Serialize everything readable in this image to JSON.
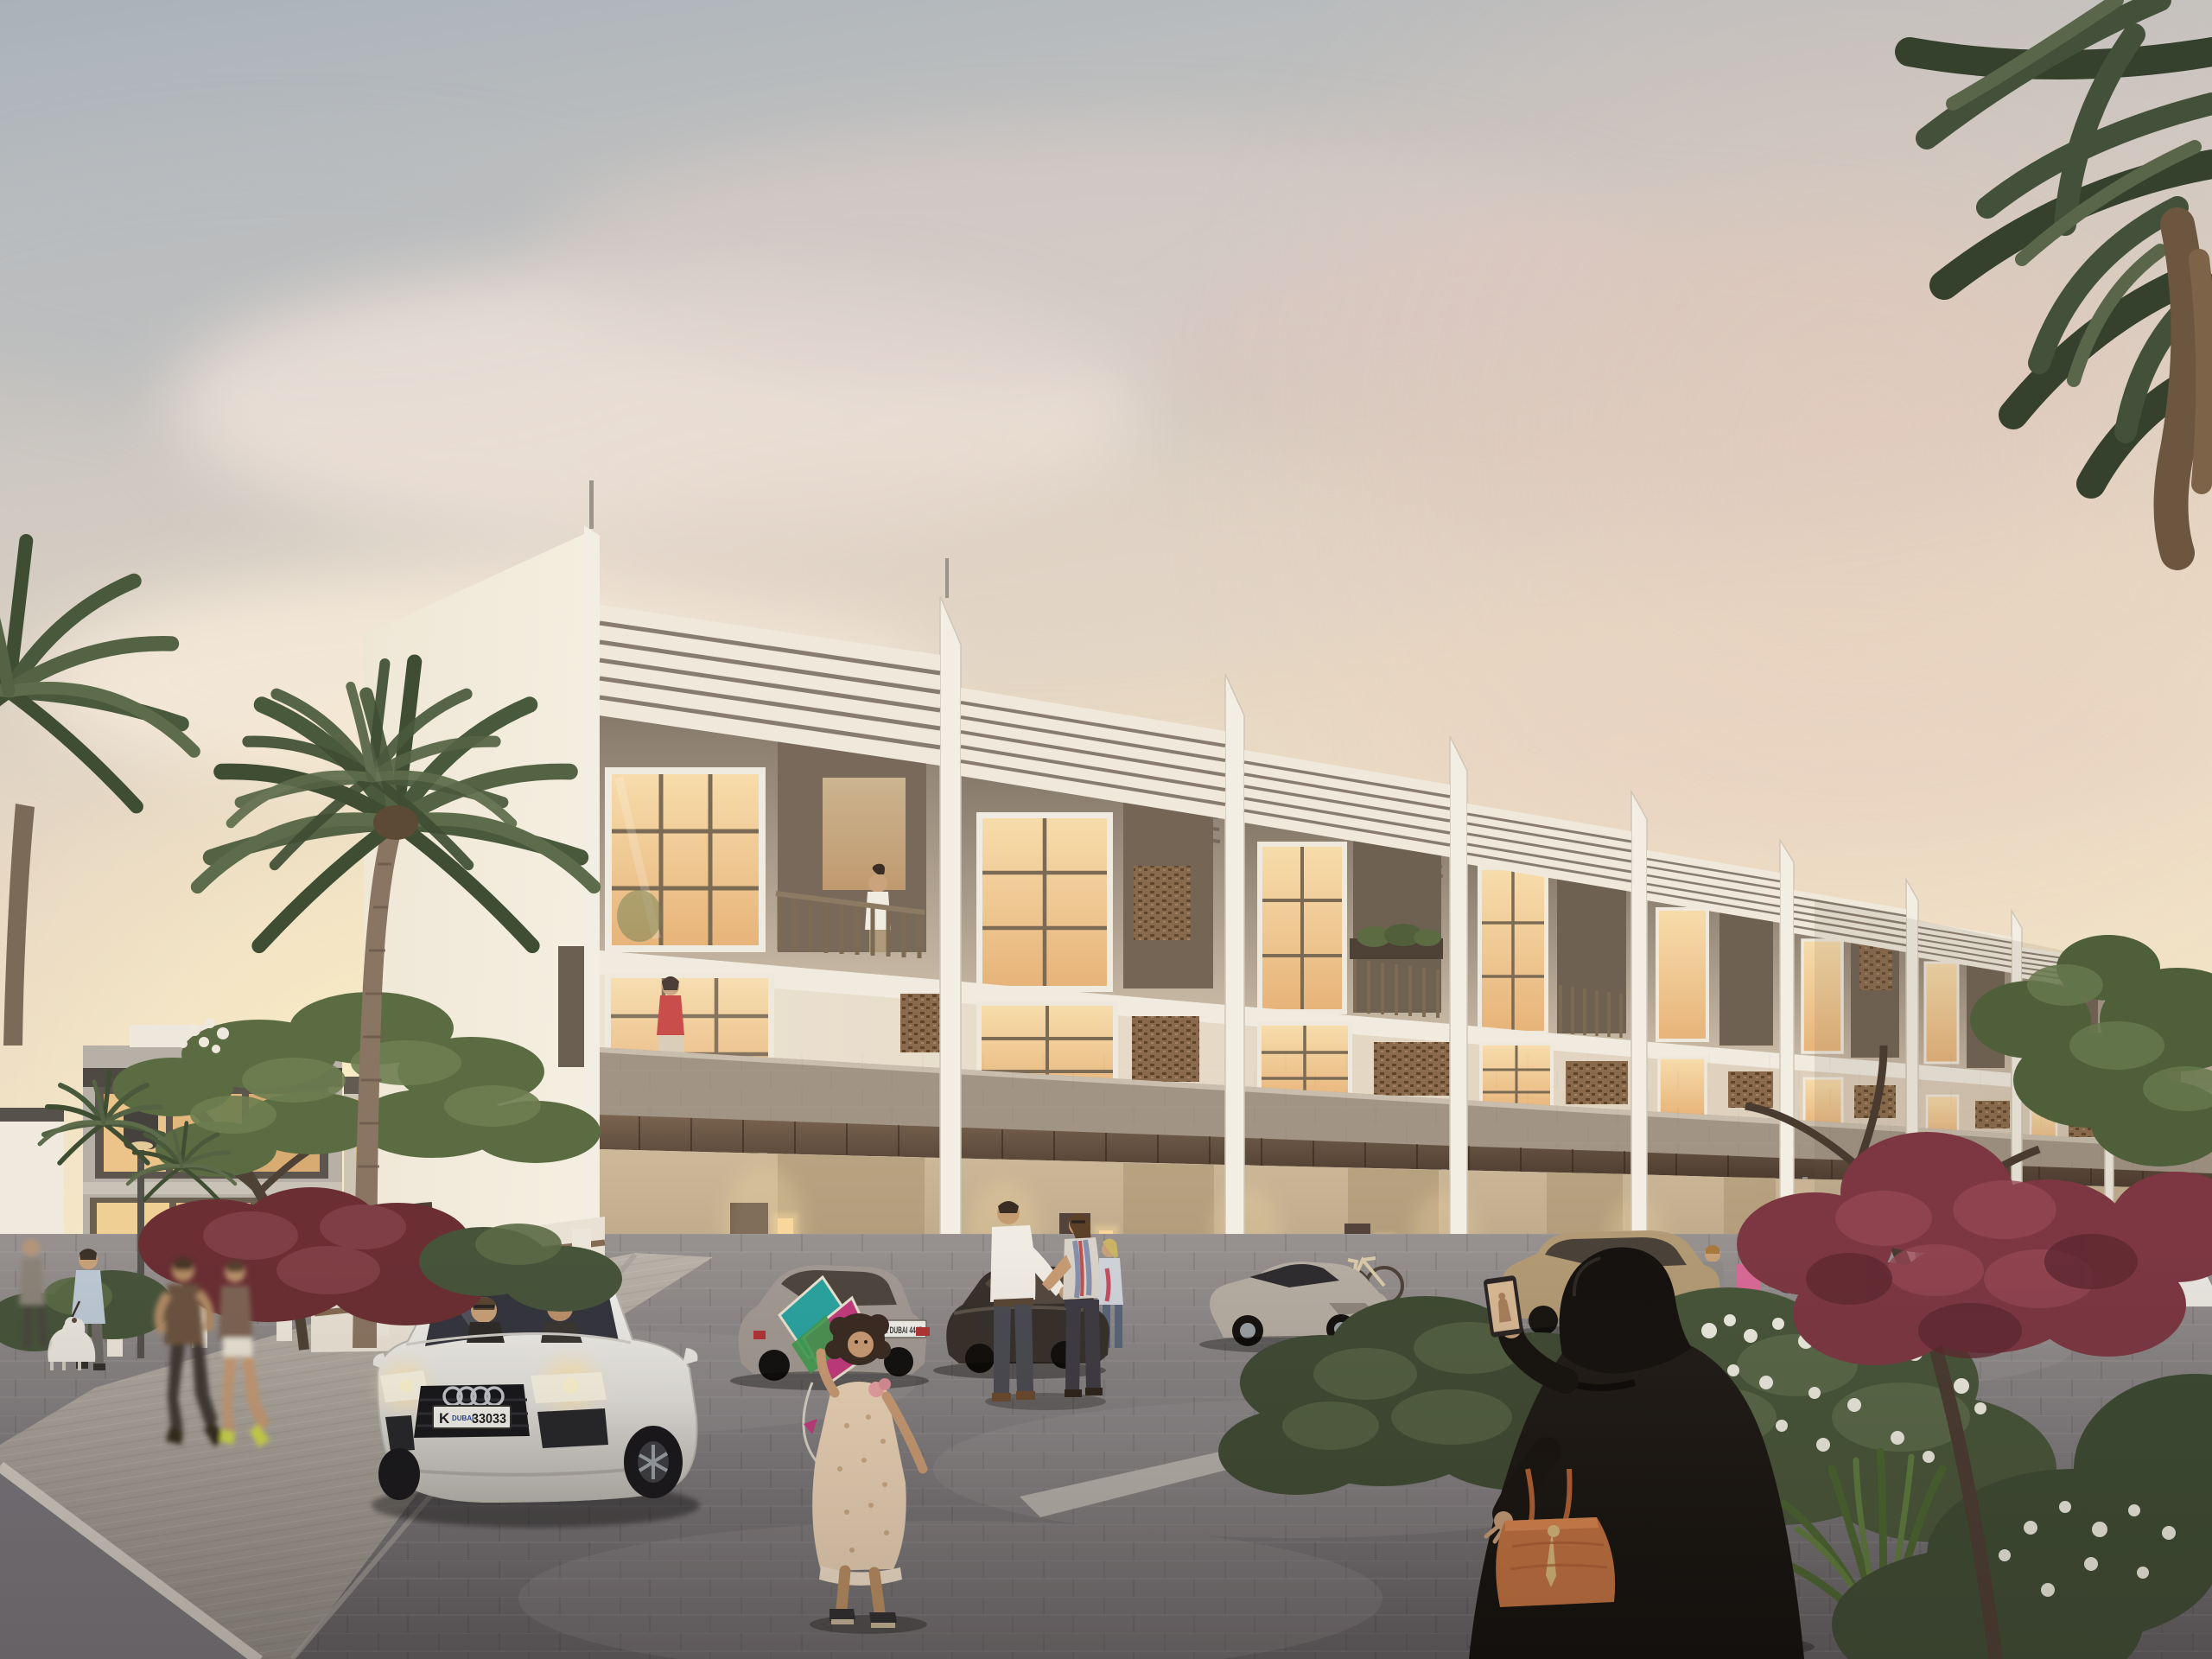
{
  "scene": {
    "description": "Dusk architectural rendering of a modern three-storey townhouse row with louvered sawtooth parapets, mashrabiya screens, lit windows, residents strolling, parked cars and palm trees",
    "license_plates": {
      "audi_front_plate": {
        "prefix": "K",
        "city": "DUBAI",
        "number": "33033"
      },
      "silver_car_plate": {
        "text": "K DUBAI 4445"
      }
    },
    "palette": {
      "sky_top": "#a9b2ba",
      "sky_horizon": "#f6e8c9",
      "cloud_pink": "#e9d6cc",
      "facade_cream": "#ece2d1",
      "facade_side_wall": "#f1eadb",
      "louver_line": "#877c6f",
      "ground_floor_brick": "#c3ae92",
      "canopy_wood": "#5f4c3a",
      "window_warm": "#f4d39d",
      "mashrabiya_brown": "#8a6a4c",
      "balcony_parapet_taupe": "#a29484",
      "pavement_grey": "#8d898b",
      "sidewalk_grey": "#b3ada5",
      "palm_green": "#4d5c3d",
      "red_foliage": "#7c3742",
      "white_blossom": "#efe9dd",
      "abaya_black": "#171310",
      "handbag_orange": "#c2703f",
      "kite_teal": "#2aa3a0",
      "kite_magenta": "#c23a7e",
      "audi_body_white": "#eceae6"
    },
    "objects": [
      "townhouse-row",
      "left-glass-villa",
      "street-lamp",
      "fence-left",
      "tall-palm-left",
      "corner-palm-right",
      "frangipani-tree",
      "red-foliage-trees",
      "white-flower-bushes",
      "spiky-plant",
      "center-bush",
      "audi-car",
      "silver-sedan",
      "dark-sedan",
      "silver-sports-car",
      "gold-suv",
      "black-car",
      "white-coupe",
      "white-sedan",
      "wall-bicycle-center",
      "wall-bicycle-right",
      "girl-with-kite",
      "talking-couple",
      "abaya-woman-with-phone",
      "man-with-white-dog",
      "white-dog",
      "left-joggers",
      "grey-coat-woman",
      "dark-coat-man",
      "cocker-spaniel",
      "jogging-women",
      "kandura-men",
      "balcony-man",
      "window-woman-red"
    ]
  }
}
